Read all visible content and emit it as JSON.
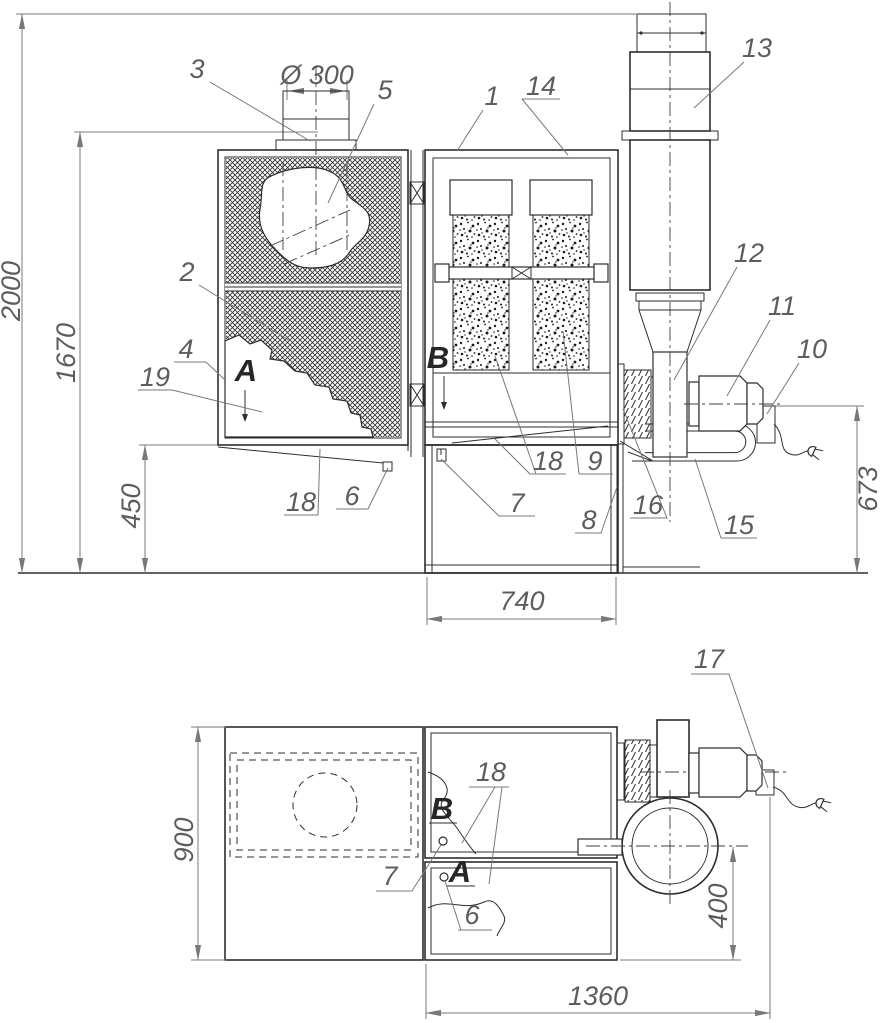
{
  "front_view": {
    "dimensions": {
      "overall_height": "2000",
      "inlet_height": "1670",
      "clearance_height": "450",
      "outlet_height": "673",
      "bin_width": "740",
      "inlet_diameter": "Ø 300"
    },
    "callouts": {
      "n1": "1",
      "n2": "2",
      "n3": "3",
      "n4": "4",
      "n5": "5",
      "n6": "6",
      "n7": "7",
      "n8": "8",
      "n9": "9",
      "n10": "10",
      "n11": "11",
      "n12": "12",
      "n13": "13",
      "n14": "14",
      "n15": "15",
      "n16": "16",
      "n18_left": "18",
      "n18_mid": "18",
      "n19": "19"
    },
    "view_arrows": {
      "a": "A",
      "b": "B"
    }
  },
  "plan_view": {
    "dimensions": {
      "depth": "900",
      "fan_offset": "400",
      "overall_length": "1360"
    },
    "callouts": {
      "n6": "6",
      "n7": "7",
      "n17": "17",
      "n18": "18"
    },
    "view_labels": {
      "a": "A",
      "b": "B"
    }
  }
}
